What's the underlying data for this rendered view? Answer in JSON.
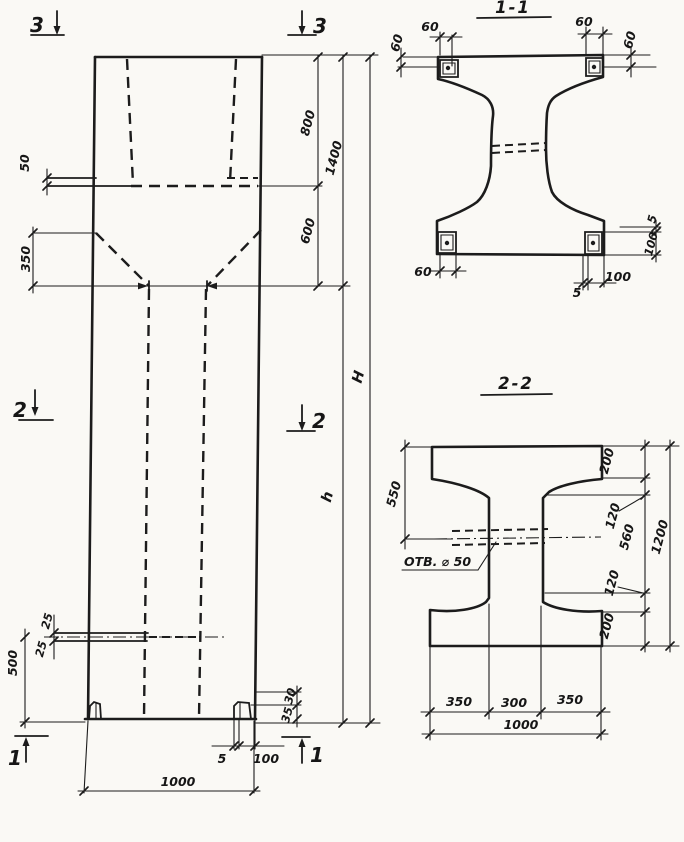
{
  "meta": {
    "background": "#faf9f5",
    "ink": "#1c1c1c",
    "drawing_type": "concrete column working drawing"
  },
  "markers": {
    "top_left": "3",
    "top_right": "3",
    "mid_left": "2",
    "mid_right": "2",
    "bottom_left": "1",
    "bottom_right": "1"
  },
  "elevation": {
    "dims": {
      "d50": "50",
      "d350": "350",
      "d800": "800",
      "d1400": "1400",
      "d600": "600",
      "height_total": "H",
      "height_shaft": "h",
      "d25_top": "25",
      "d25_bot": "25",
      "d500": "500",
      "d30": "30",
      "d35": "35",
      "d5": "5",
      "d100": "100",
      "d1000": "1000"
    }
  },
  "section_1_1": {
    "title": "1-1",
    "dims": {
      "d60_tl_w": "60",
      "d60_tl_e": "60",
      "d60_tr_w": "60",
      "d60_tr_e": "60",
      "d60_bl": "60",
      "d5_bottom": "5",
      "d100_bottom": "100",
      "d5_right": "5",
      "d100_right": "100"
    }
  },
  "section_2_2": {
    "title": "2-2",
    "hole_label": "ОТВ. ⌀ 50",
    "dims": {
      "d550": "550",
      "d200_top": "200",
      "d120_top": "120",
      "d560": "560",
      "d120_bot": "120",
      "d200_bot": "200",
      "d1200": "1200",
      "d350_left": "350",
      "d300": "300",
      "d350_right": "350",
      "d1000": "1000"
    }
  }
}
